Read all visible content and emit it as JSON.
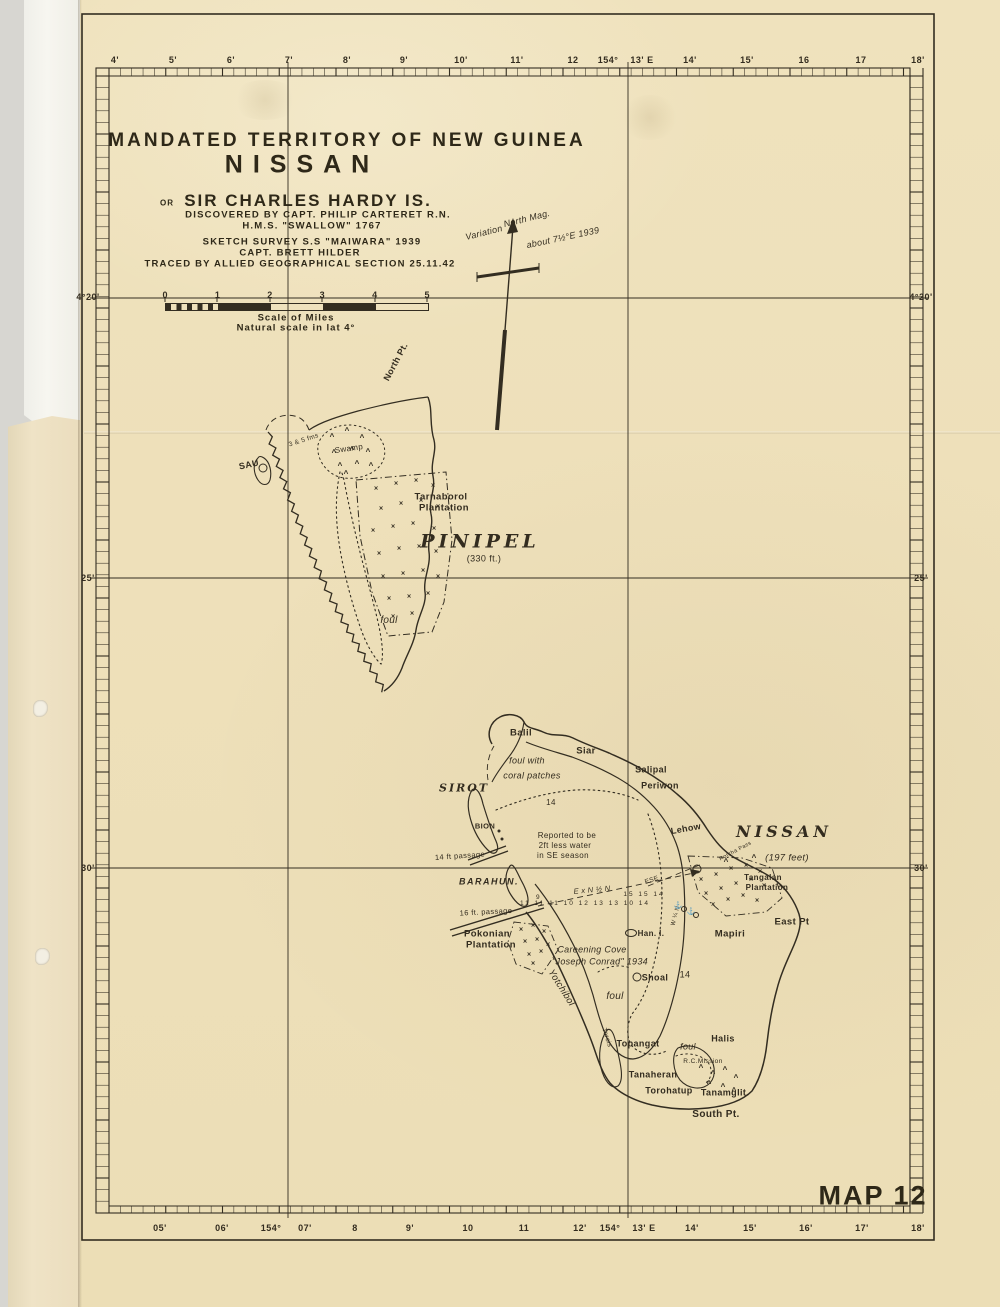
{
  "page": {
    "map_number": "MAP 12"
  },
  "title_block": {
    "territory": "MANDATED TERRITORY OF NEW GUINEA",
    "island_name": "NISSAN",
    "or": "OR",
    "alt_name": "SIR CHARLES HARDY IS.",
    "discovered": "DISCOVERED BY CAPT. PHILIP CARTERET R.N.",
    "ship": "H.M.S. \"SWALLOW\" 1767",
    "survey": "SKETCH SURVEY S.S \"MAIWARA\" 1939",
    "captain": "CAPT. BRETT HILDER",
    "traced": "TRACED BY ALLIED GEOGRAPHICAL SECTION 25.11.42"
  },
  "scale_bar": {
    "numbers": [
      "0",
      "1",
      "2",
      "3",
      "4",
      "5"
    ],
    "caption_line1": "Scale of Miles",
    "caption_line2": "Natural scale in lat 4°"
  },
  "graticule": {
    "top": [
      {
        "t": "4'",
        "x": 115
      },
      {
        "t": "5'",
        "x": 173
      },
      {
        "t": "6'",
        "x": 231
      },
      {
        "t": "7'",
        "x": 289
      },
      {
        "t": "8'",
        "x": 347
      },
      {
        "t": "9'",
        "x": 404
      },
      {
        "t": "10'",
        "x": 461
      },
      {
        "t": "11'",
        "x": 517
      },
      {
        "t": "12",
        "x": 573
      },
      {
        "t": "154°",
        "x": 608
      },
      {
        "t": "13' E",
        "x": 642
      },
      {
        "t": "14'",
        "x": 690
      },
      {
        "t": "15'",
        "x": 747
      },
      {
        "t": "16",
        "x": 804
      },
      {
        "t": "17",
        "x": 861
      },
      {
        "t": "18'",
        "x": 918
      }
    ],
    "bottom": [
      {
        "t": "05'",
        "x": 160
      },
      {
        "t": "06'",
        "x": 222
      },
      {
        "t": "154°",
        "x": 271
      },
      {
        "t": "07'",
        "x": 305
      },
      {
        "t": "8",
        "x": 355
      },
      {
        "t": "9'",
        "x": 410
      },
      {
        "t": "10",
        "x": 468
      },
      {
        "t": "11",
        "x": 524
      },
      {
        "t": "12'",
        "x": 580
      },
      {
        "t": "154°",
        "x": 610
      },
      {
        "t": "13' E",
        "x": 644
      },
      {
        "t": "14'",
        "x": 692
      },
      {
        "t": "15'",
        "x": 750
      },
      {
        "t": "16'",
        "x": 806
      },
      {
        "t": "17'",
        "x": 862
      },
      {
        "t": "18'",
        "x": 918
      }
    ],
    "left": [
      {
        "t": "4°20'",
        "y": 297
      },
      {
        "t": "25'",
        "y": 578
      },
      {
        "t": "30'",
        "y": 868
      }
    ],
    "right": [
      {
        "t": "4°20'",
        "y": 297
      },
      {
        "t": "25'",
        "y": 578
      },
      {
        "t": "30'",
        "y": 868
      }
    ]
  },
  "labels": [
    {
      "n": "north-mag",
      "t": "North Mag.",
      "x": 527,
      "y": 219,
      "s": 9,
      "r": -14,
      "c": "script"
    },
    {
      "n": "variation",
      "t": "Variation",
      "x": 484,
      "y": 233,
      "s": 9,
      "r": -14,
      "c": "script"
    },
    {
      "n": "variation-value",
      "t": "about 7½°E 1939",
      "x": 563,
      "y": 238,
      "s": 9,
      "r": -12,
      "c": "script"
    },
    {
      "n": "north-pt",
      "t": "North Pt.",
      "x": 396,
      "y": 362,
      "s": 9,
      "r": -62
    },
    {
      "n": "sau",
      "t": "SAU",
      "x": 249,
      "y": 465,
      "s": 9,
      "r": -12
    },
    {
      "n": "fathoms-note",
      "t": "3 & 5 fms",
      "x": 304,
      "y": 441,
      "s": 6.5,
      "r": -18,
      "c": "thin"
    },
    {
      "n": "swamp",
      "t": "Swamp",
      "x": 349,
      "y": 449,
      "s": 8,
      "r": -8,
      "c": "thin"
    },
    {
      "n": "tarnaborol",
      "t": "Tarnaborol",
      "x": 441,
      "y": 497,
      "s": 9.5
    },
    {
      "n": "tarnaborol-2",
      "t": "Plantation",
      "x": 444,
      "y": 508,
      "s": 9.5
    },
    {
      "n": "pinipel",
      "t": "PINIPEL",
      "x": 480,
      "y": 542,
      "s": 19,
      "c": "island"
    },
    {
      "n": "pinipel-elev",
      "t": "(330 ft.)",
      "x": 484,
      "y": 559,
      "s": 9,
      "c": "thin"
    },
    {
      "n": "foul-pinipel",
      "t": "foul",
      "x": 389,
      "y": 621,
      "s": 10,
      "c": "script"
    },
    {
      "n": "balil",
      "t": "Balil",
      "x": 521,
      "y": 733,
      "s": 9.5
    },
    {
      "n": "siar",
      "t": "Siar",
      "x": 586,
      "y": 751,
      "s": 9.5
    },
    {
      "n": "foul-coral-1",
      "t": "foul with",
      "x": 527,
      "y": 761,
      "s": 9,
      "c": "script"
    },
    {
      "n": "foul-coral-2",
      "t": "coral patches",
      "x": 532,
      "y": 776,
      "s": 9,
      "c": "script"
    },
    {
      "n": "sirot",
      "t": "SIROT",
      "x": 464,
      "y": 788,
      "s": 11,
      "c": "island2"
    },
    {
      "n": "salipal",
      "t": "Salipal",
      "x": 651,
      "y": 770,
      "s": 9
    },
    {
      "n": "periwon",
      "t": "Periwon",
      "x": 660,
      "y": 786,
      "s": 9
    },
    {
      "n": "sounding-14a",
      "t": "14",
      "x": 551,
      "y": 803,
      "s": 8,
      "c": "thin"
    },
    {
      "n": "bion",
      "t": "BION",
      "x": 485,
      "y": 826,
      "s": 7.5
    },
    {
      "n": "lehow",
      "t": "Lehow",
      "x": 686,
      "y": 829,
      "s": 9,
      "r": -10
    },
    {
      "n": "reported-1",
      "t": "Reported to be",
      "x": 567,
      "y": 836,
      "s": 8,
      "c": "thin"
    },
    {
      "n": "reported-2",
      "t": "2ft less water",
      "x": 565,
      "y": 846,
      "s": 8,
      "c": "thin"
    },
    {
      "n": "reported-3",
      "t": "in SE season",
      "x": 563,
      "y": 856,
      "s": 8,
      "c": "thin"
    },
    {
      "n": "passage-14ft",
      "t": "14 ft passage",
      "x": 460,
      "y": 856,
      "s": 7.5,
      "r": -4,
      "c": "thin"
    },
    {
      "n": "nissan",
      "t": "NISSAN",
      "x": 784,
      "y": 832,
      "s": 16,
      "c": "island"
    },
    {
      "n": "nissan-elev",
      "t": "(197 feet)",
      "x": 787,
      "y": 858,
      "s": 9.5,
      "c": "script"
    },
    {
      "n": "barahun",
      "t": "BARAHUN.",
      "x": 489,
      "y": 882,
      "s": 9,
      "c": "bara"
    },
    {
      "n": "bearing-exn",
      "t": "E x N ½ N",
      "x": 592,
      "y": 890,
      "s": 7.5,
      "r": -5,
      "c": "script"
    },
    {
      "n": "sounding-9",
      "t": "9",
      "x": 538,
      "y": 898,
      "s": 6.5,
      "c": "thin"
    },
    {
      "n": "sounding-row",
      "t": "11 11 11 10 12 13 13 10 14",
      "x": 585,
      "y": 904,
      "s": 6.5,
      "c": "sp"
    },
    {
      "n": "sounding-row-2",
      "t": "15 15 14",
      "x": 644,
      "y": 895,
      "s": 6.5,
      "c": "sp"
    },
    {
      "n": "bearing-ese",
      "t": "ESE",
      "x": 652,
      "y": 881,
      "s": 6.5,
      "r": -18,
      "c": "thin"
    },
    {
      "n": "passage-16ft",
      "t": "16 ft. passage",
      "x": 486,
      "y": 912,
      "s": 7.5,
      "r": -3,
      "c": "thin"
    },
    {
      "n": "pokonian",
      "t": "Pokonian",
      "x": 487,
      "y": 934,
      "s": 9.5
    },
    {
      "n": "pokonian-2",
      "t": "Plantation",
      "x": 491,
      "y": 945,
      "s": 9.5
    },
    {
      "n": "careening-1",
      "t": "Careening Cove",
      "x": 592,
      "y": 950,
      "s": 9,
      "c": "script"
    },
    {
      "n": "careening-2",
      "t": "\"Joseph Conrad\" 1934",
      "x": 600,
      "y": 962,
      "s": 9,
      "c": "script"
    },
    {
      "n": "han-island",
      "t": "Han. I.",
      "x": 651,
      "y": 934,
      "s": 8
    },
    {
      "n": "shoal",
      "t": "Shoal",
      "x": 655,
      "y": 978,
      "s": 9
    },
    {
      "n": "sounding-14b",
      "t": "14",
      "x": 685,
      "y": 975,
      "s": 9,
      "c": "thin"
    },
    {
      "n": "yotchibol",
      "t": "Yotchibol",
      "x": 561,
      "y": 988,
      "s": 9.5,
      "r": 58,
      "c": "script"
    },
    {
      "n": "foul-nissan-w",
      "t": "foul",
      "x": 615,
      "y": 997,
      "s": 10,
      "c": "script"
    },
    {
      "n": "torois",
      "t": "Torois",
      "x": 606,
      "y": 1038,
      "s": 6.5,
      "r": 72,
      "c": "thin"
    },
    {
      "n": "topangat",
      "t": "Topangat",
      "x": 638,
      "y": 1044,
      "s": 9
    },
    {
      "n": "foul-nissan-s",
      "t": "foul",
      "x": 688,
      "y": 1047,
      "s": 9,
      "c": "script"
    },
    {
      "n": "halis",
      "t": "Halis",
      "x": 723,
      "y": 1039,
      "s": 9
    },
    {
      "n": "rc-mission",
      "t": "R.C.Mission",
      "x": 703,
      "y": 1062,
      "s": 6.5,
      "c": "thin"
    },
    {
      "n": "tanaheran",
      "t": "Tanaheran",
      "x": 653,
      "y": 1075,
      "s": 9
    },
    {
      "n": "torohatup",
      "t": "Torohatup",
      "x": 669,
      "y": 1091,
      "s": 9
    },
    {
      "n": "tanamglit",
      "t": "Tanamglit.",
      "x": 725,
      "y": 1093,
      "s": 9
    },
    {
      "n": "south-pt",
      "t": "South Pt.",
      "x": 716,
      "y": 1115,
      "s": 10
    },
    {
      "n": "mapiri",
      "t": "Mapiri",
      "x": 730,
      "y": 934,
      "s": 9.5
    },
    {
      "n": "east-pt",
      "t": "East Pt",
      "x": 792,
      "y": 922,
      "s": 9.5
    },
    {
      "n": "tangalan",
      "t": "Tangalan",
      "x": 763,
      "y": 878,
      "s": 8
    },
    {
      "n": "tangalan-2",
      "t": "Plantation",
      "x": 767,
      "y": 888,
      "s": 8
    },
    {
      "n": "bearing-wqn",
      "t": "W ¼ N",
      "x": 676,
      "y": 916,
      "s": 6,
      "r": -75,
      "c": "thin"
    },
    {
      "n": "reef-pass",
      "t": "Rotcha Pass",
      "x": 736,
      "y": 852,
      "s": 5.5,
      "r": -28,
      "c": "thin"
    }
  ],
  "marks": [
    {
      "k": "t",
      "x": 332,
      "y": 437
    },
    {
      "k": "t",
      "x": 347,
      "y": 431
    },
    {
      "k": "t",
      "x": 362,
      "y": 438
    },
    {
      "k": "t",
      "x": 334,
      "y": 453
    },
    {
      "k": "t",
      "x": 352,
      "y": 450
    },
    {
      "k": "t",
      "x": 368,
      "y": 452
    },
    {
      "k": "t",
      "x": 340,
      "y": 466
    },
    {
      "k": "t",
      "x": 357,
      "y": 464
    },
    {
      "k": "t",
      "x": 371,
      "y": 466
    },
    {
      "k": "t",
      "x": 346,
      "y": 474
    },
    {
      "k": "x",
      "x": 376,
      "y": 489
    },
    {
      "k": "x",
      "x": 396,
      "y": 484
    },
    {
      "k": "x",
      "x": 416,
      "y": 481
    },
    {
      "k": "x",
      "x": 433,
      "y": 486
    },
    {
      "k": "x",
      "x": 381,
      "y": 509
    },
    {
      "k": "x",
      "x": 401,
      "y": 504
    },
    {
      "k": "x",
      "x": 421,
      "y": 501
    },
    {
      "k": "x",
      "x": 438,
      "y": 507
    },
    {
      "k": "x",
      "x": 373,
      "y": 531
    },
    {
      "k": "x",
      "x": 393,
      "y": 527
    },
    {
      "k": "x",
      "x": 413,
      "y": 524
    },
    {
      "k": "x",
      "x": 434,
      "y": 529
    },
    {
      "k": "x",
      "x": 379,
      "y": 554
    },
    {
      "k": "x",
      "x": 399,
      "y": 549
    },
    {
      "k": "x",
      "x": 419,
      "y": 547
    },
    {
      "k": "x",
      "x": 436,
      "y": 552
    },
    {
      "k": "x",
      "x": 383,
      "y": 577
    },
    {
      "k": "x",
      "x": 403,
      "y": 574
    },
    {
      "k": "x",
      "x": 423,
      "y": 571
    },
    {
      "k": "x",
      "x": 438,
      "y": 577
    },
    {
      "k": "x",
      "x": 389,
      "y": 599
    },
    {
      "k": "x",
      "x": 409,
      "y": 597
    },
    {
      "k": "x",
      "x": 428,
      "y": 594
    },
    {
      "k": "x",
      "x": 393,
      "y": 617
    },
    {
      "k": "x",
      "x": 412,
      "y": 614
    },
    {
      "k": "c",
      "x": 263,
      "y": 468
    },
    {
      "k": "d",
      "x": 499,
      "y": 831
    },
    {
      "k": "d",
      "x": 502,
      "y": 839
    },
    {
      "k": "x",
      "x": 701,
      "y": 880
    },
    {
      "k": "x",
      "x": 716,
      "y": 875
    },
    {
      "k": "x",
      "x": 731,
      "y": 869
    },
    {
      "k": "x",
      "x": 746,
      "y": 866
    },
    {
      "k": "x",
      "x": 760,
      "y": 872
    },
    {
      "k": "x",
      "x": 706,
      "y": 894
    },
    {
      "k": "x",
      "x": 721,
      "y": 889
    },
    {
      "k": "x",
      "x": 736,
      "y": 884
    },
    {
      "k": "x",
      "x": 751,
      "y": 880
    },
    {
      "k": "x",
      "x": 764,
      "y": 886
    },
    {
      "k": "x",
      "x": 713,
      "y": 905
    },
    {
      "k": "x",
      "x": 728,
      "y": 900
    },
    {
      "k": "x",
      "x": 743,
      "y": 896
    },
    {
      "k": "x",
      "x": 757,
      "y": 901
    },
    {
      "k": "t",
      "x": 726,
      "y": 862
    },
    {
      "k": "t",
      "x": 754,
      "y": 858
    },
    {
      "k": "c",
      "x": 697,
      "y": 869
    },
    {
      "k": "x",
      "x": 521,
      "y": 930
    },
    {
      "k": "x",
      "x": 533,
      "y": 926
    },
    {
      "k": "x",
      "x": 544,
      "y": 932
    },
    {
      "k": "x",
      "x": 525,
      "y": 942
    },
    {
      "k": "x",
      "x": 537,
      "y": 940
    },
    {
      "k": "x",
      "x": 548,
      "y": 945
    },
    {
      "k": "x",
      "x": 529,
      "y": 955
    },
    {
      "k": "x",
      "x": 541,
      "y": 952
    },
    {
      "k": "x",
      "x": 533,
      "y": 964
    },
    {
      "k": "t",
      "x": 701,
      "y": 1068
    },
    {
      "k": "t",
      "x": 713,
      "y": 1074
    },
    {
      "k": "t",
      "x": 725,
      "y": 1070
    },
    {
      "k": "t",
      "x": 736,
      "y": 1078
    },
    {
      "k": "t",
      "x": 709,
      "y": 1084
    },
    {
      "k": "t",
      "x": 723,
      "y": 1087
    },
    {
      "k": "t",
      "x": 734,
      "y": 1091
    },
    {
      "k": "c",
      "x": 637,
      "y": 977
    },
    {
      "k": "i",
      "x": 631,
      "y": 933
    },
    {
      "k": "a",
      "x": 678,
      "y": 906
    },
    {
      "k": "a",
      "x": 691,
      "y": 912
    },
    {
      "k": "c2",
      "x": 684,
      "y": 909
    },
    {
      "k": "c2",
      "x": 696,
      "y": 915
    }
  ],
  "colors": {
    "paper": "#eee0ba",
    "ink": "#332d21",
    "under_sheet": "#efe3c6",
    "white_sheet": "#f7f6f0"
  }
}
